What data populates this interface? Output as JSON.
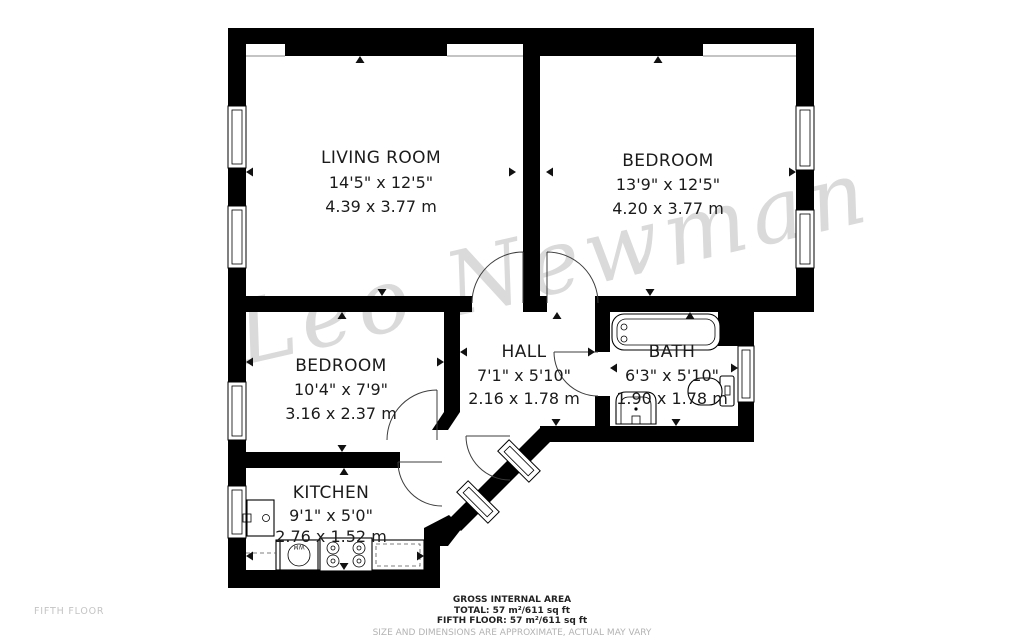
{
  "watermark": "Leo Newman",
  "floor_label": "FIFTH FLOOR",
  "rooms": [
    {
      "id": "living-room",
      "name": "LIVING ROOM",
      "imperial": "14'5\" x 12'5\"",
      "metric": "4.39 x 3.77 m"
    },
    {
      "id": "bedroom-1",
      "name": "BEDROOM",
      "imperial": "13'9\" x 12'5\"",
      "metric": "4.20 x 3.77 m"
    },
    {
      "id": "bedroom-2",
      "name": "BEDROOM",
      "imperial": "10'4\" x 7'9\"",
      "metric": "3.16 x 2.37 m"
    },
    {
      "id": "hall",
      "name": "HALL",
      "imperial": "7'1\" x 5'10\"",
      "metric": "2.16 x 1.78 m"
    },
    {
      "id": "bath",
      "name": "BATH",
      "imperial": "6'3\" x 5'10\"",
      "metric": "1.90 x 1.78 m"
    },
    {
      "id": "kitchen",
      "name": "KITCHEN",
      "imperial": "9'1\" x 5'0\"",
      "metric": "2.76 x 1.52 m"
    }
  ],
  "fixtures": {
    "wm_label": "WM",
    "bath": [
      "bathtub",
      "washbasin",
      "toilet"
    ],
    "kitchen": [
      "washing-machine",
      "hob",
      "counter",
      "boiler-cupboard"
    ]
  },
  "footer": {
    "title": "GROSS INTERNAL AREA",
    "total": "TOTAL: 57 m²/611 sq ft",
    "floor_total": "FIFTH FLOOR: 57 m²/611 sq ft",
    "disclaimer": "SIZE AND DIMENSIONS ARE APPROXIMATE, ACTUAL MAY VARY"
  },
  "colors": {
    "wall": "#000000",
    "watermark": "#dadada",
    "label_text": "#1b1b1b",
    "muted_text": "#b3b3b3"
  }
}
